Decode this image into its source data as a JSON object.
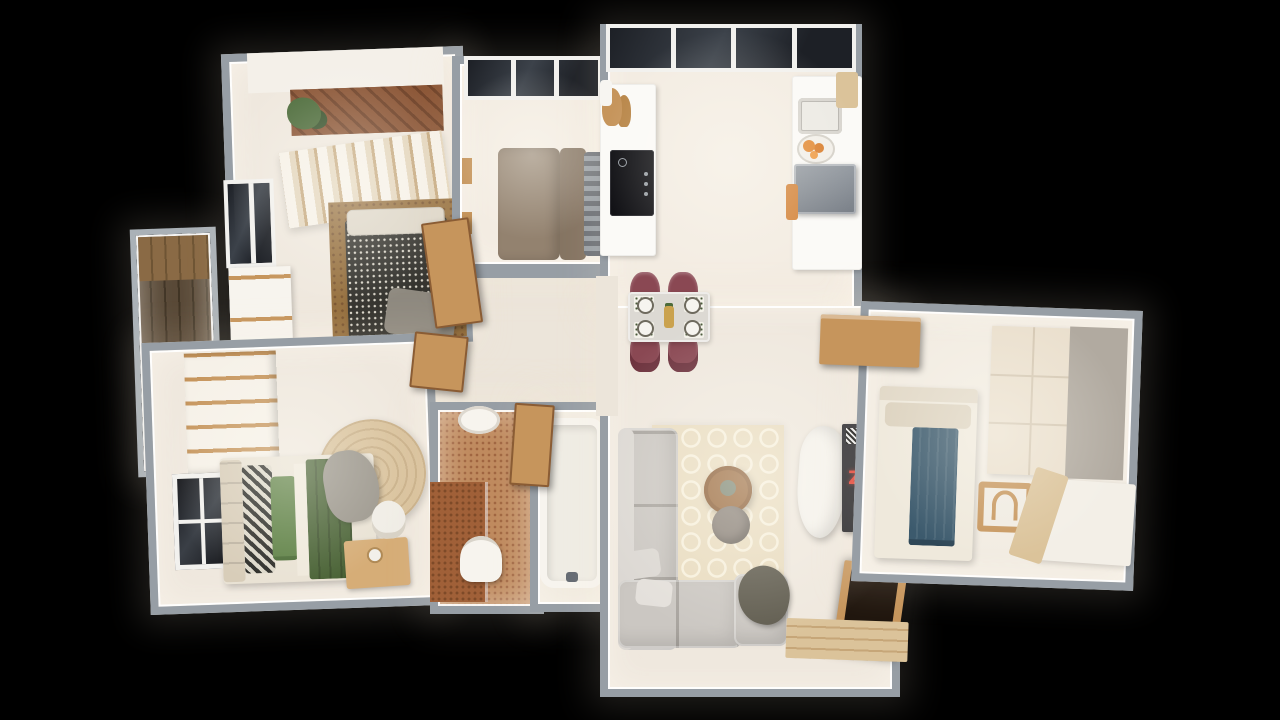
{
  "scene": {
    "description": "3D top-down dollhouse render of a furnished apartment floor plan on a black background",
    "tv_glyph": "Z"
  },
  "palette": {
    "bg": "#000000",
    "glow": "rgba(255,238,214,0.13)",
    "wall": "#979ea5",
    "wall_light": "#aab1b7",
    "floor": "#efe8de",
    "floor_warm": "#f3ece2",
    "hall_floor": "#ece5da",
    "counter": "#fbfaf7",
    "cooktop": "#121216",
    "appliance": "#7b8189",
    "appliance_top": "#959ba2",
    "window_dark": "#1d2026",
    "window_mid": "#3c424a",
    "frame_white": "#f2f1ee",
    "burgundy": "#8a4853",
    "burgundy_dk": "#6e343f",
    "table_top": "#dcd9d3",
    "wood": "#c6955c",
    "wood_dk": "#8a5c34",
    "wood_light": "#dbc39a",
    "sofa": "#cbc7c2",
    "sofa_light": "#dcd8d3",
    "rug": "#e9dcc0",
    "rug_pat": "#f7f0dd",
    "coffee_table": "#9a6a3e",
    "pouf": "#8b8279",
    "throw_olive": "#5f5b4e",
    "garment_white": "#f5f2ec",
    "tv_black": "#1b1b20",
    "tv_red": "#e23b2e",
    "herr_a": "#8a5434",
    "herr_b": "#6e4026",
    "plant": "#4c6b3a",
    "plant_dk": "#36502a",
    "curt_a": "#f6f1e8",
    "curt_b": "#e3d5bc",
    "curt_c": "#c5a87e",
    "hound_bg": "#34332e",
    "hound_dot": "#d8d4c8",
    "rug_brown": "#96703f",
    "pillow_cream": "#ddd6c8",
    "throw_gray": "#8e897f",
    "taupe": "#93826f",
    "taupe_dk": "#857462",
    "strg_a": "#6d7177",
    "strg_b": "#9aa0a6",
    "bed_white": "#efe9dc",
    "throw_blue": "#3c5a6d",
    "throw_blue_dk": "#2f4757",
    "wardrobe_beige": "#eadfcd",
    "wardrobe_side": "#b1aaa0",
    "green_blanket": "#4a6336",
    "green_pillow": "#5d8044",
    "headboard": "#d8cdb9",
    "jute": "#d9c29c",
    "jute_ring": "#c9b089",
    "terracotta": "#bf8a5e",
    "terracotta_dk": "#a06540",
    "shower_dk": "#a06038",
    "white_fix": "#f7f4ee",
    "deck_a": "#584836",
    "deck_b": "#3e3222",
    "deck_light": "#8a6a45",
    "orange": "#e28a36"
  },
  "rooms": [
    {
      "id": "kitchen",
      "label": "kitchen"
    },
    {
      "id": "living-dining",
      "label": "living and dining room"
    },
    {
      "id": "bedroom-right",
      "label": "right bedroom"
    },
    {
      "id": "bedroom-top-left",
      "label": "top-left bedroom with balcony"
    },
    {
      "id": "small-bedroom",
      "label": "small bedroom"
    },
    {
      "id": "master-bedroom",
      "label": "master bedroom"
    },
    {
      "id": "bathroom-terracotta",
      "label": "terracotta bathroom"
    },
    {
      "id": "bathroom-bathtub",
      "label": "bathtub bathroom"
    },
    {
      "id": "hallway",
      "label": "hallway"
    },
    {
      "id": "balcony-left",
      "label": "left balcony with wood deck"
    }
  ],
  "furniture": {
    "kitchen": [
      "window-band",
      "left-counter",
      "cooktop",
      "cutting-boards",
      "right-counter",
      "sink",
      "fruit-bowl",
      "gray-appliance",
      "orange-cloth",
      "wall-shelf"
    ],
    "living_dining": [
      "dining-table",
      "four-burgundy-chairs",
      "placemats",
      "trellis-rug",
      "l-shaped-sofa",
      "armchair-with-olive-throw",
      "coffee-table",
      "pouf",
      "hanging-garment",
      "dark-panel-with-red-glyph",
      "entry-door",
      "entry-mat"
    ],
    "bedroom_right": [
      "bed-with-blue-throw",
      "wooden-chair",
      "beige-wardrobe",
      "desk",
      "wood-sideboard"
    ],
    "bedroom_top_left": [
      "herringbone-balcony",
      "plant",
      "striped-curtains",
      "houndstooth-bed",
      "brown-rug",
      "left-window",
      "white-wardrobe"
    ],
    "small_bedroom": [
      "window-band",
      "taupe-daybed",
      "striped-cushions"
    ],
    "master_bedroom": [
      "striped-closet",
      "mirror-panel",
      "green-bed",
      "patterned-pillows",
      "round-jute-rug",
      "vanity-desk",
      "white-chair"
    ],
    "bathroom_terracotta": [
      "shower-area",
      "toilet",
      "basin"
    ],
    "bathroom_bathtub": [
      "bathtub",
      "faucet"
    ],
    "hallway": [
      "open-wood-doors"
    ]
  }
}
